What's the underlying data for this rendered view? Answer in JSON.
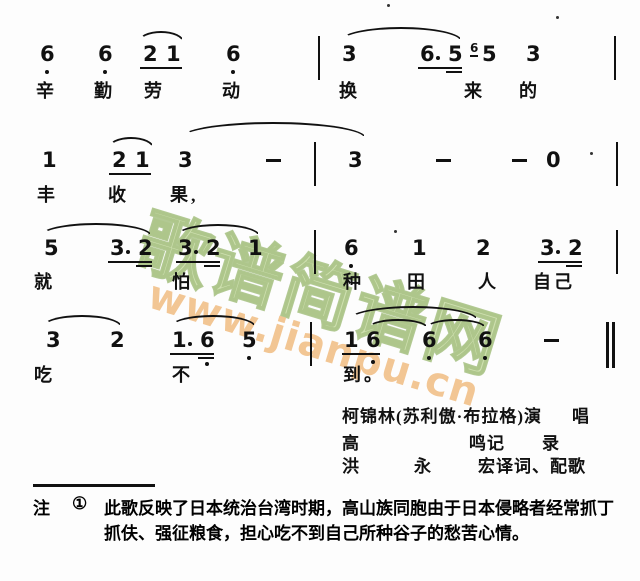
{
  "page": {
    "background": "#fdfdfd",
    "ink_color": "#111111"
  },
  "watermark": {
    "brand_text": "歌谱简谱网",
    "url_text": "www.jianpu.cn",
    "brand_color": "#cfe0b0",
    "url_color": "#f2c694"
  },
  "score": {
    "lines": [
      {
        "y": 44,
        "ly": 77,
        "items": [
          {
            "k": "slur",
            "x": 138,
            "dy": -13,
            "w": 46,
            "h": 11
          },
          {
            "k": "slur",
            "x": 340,
            "dy": -17,
            "w": 122,
            "h": 14
          },
          {
            "k": "d",
            "t": "6",
            "x": 40
          },
          {
            "k": "od",
            "x": 45
          },
          {
            "k": "d",
            "t": "6",
            "x": 98
          },
          {
            "k": "od",
            "x": 103
          },
          {
            "k": "d",
            "t": "2",
            "x": 143
          },
          {
            "k": "d",
            "t": "1",
            "x": 166
          },
          {
            "k": "u",
            "x": 140,
            "w": 42
          },
          {
            "k": "d",
            "t": "6",
            "x": 226
          },
          {
            "k": "od",
            "x": 231
          },
          {
            "k": "bar",
            "x": 318
          },
          {
            "k": "d",
            "t": "3",
            "x": 342
          },
          {
            "k": "d",
            "t": "6",
            "x": 420
          },
          {
            "k": "rdot",
            "x": 436
          },
          {
            "k": "d",
            "t": "5",
            "x": 448
          },
          {
            "k": "u",
            "x": 418,
            "w": 44
          },
          {
            "k": "u2",
            "x": 446,
            "w": 16
          },
          {
            "k": "grace",
            "t": "6",
            "x": 470
          },
          {
            "k": "d",
            "t": "5",
            "x": 482
          },
          {
            "k": "d",
            "t": "3",
            "x": 526
          },
          {
            "k": "bar",
            "x": 614
          },
          {
            "k": "spk",
            "x": 556,
            "dy": -28
          },
          {
            "k": "spk",
            "x": 387,
            "dy": -40
          }
        ],
        "lyrics": [
          {
            "x": 36,
            "t": "辛"
          },
          {
            "x": 94,
            "t": "勤"
          },
          {
            "x": 144,
            "t": "劳"
          },
          {
            "x": 222,
            "t": "动"
          },
          {
            "x": 339,
            "t": "换"
          },
          {
            "x": 464,
            "t": "来"
          },
          {
            "x": 519,
            "t": "的"
          }
        ]
      },
      {
        "y": 150,
        "ly": 181,
        "items": [
          {
            "k": "slur",
            "x": 108,
            "dy": -13,
            "w": 46,
            "h": 11
          },
          {
            "k": "slur",
            "x": 180,
            "dy": -28,
            "w": 186,
            "h": 16
          },
          {
            "k": "d",
            "t": "1",
            "x": 42
          },
          {
            "k": "d",
            "t": "2",
            "x": 112
          },
          {
            "k": "d",
            "t": "1",
            "x": 135
          },
          {
            "k": "u",
            "x": 109,
            "w": 42
          },
          {
            "k": "d",
            "t": "3",
            "x": 178
          },
          {
            "k": "dash",
            "x": 266
          },
          {
            "k": "bar",
            "x": 314
          },
          {
            "k": "d",
            "t": "3",
            "x": 348
          },
          {
            "k": "dash",
            "x": 436
          },
          {
            "k": "dash",
            "x": 512
          },
          {
            "k": "d",
            "t": "0",
            "x": 546
          },
          {
            "k": "spk",
            "x": 590,
            "dy": 2
          },
          {
            "k": "bar",
            "x": 616
          }
        ],
        "lyrics": [
          {
            "x": 37,
            "t": "丰"
          },
          {
            "x": 108,
            "t": "收"
          },
          {
            "x": 170,
            "t": "果,"
          }
        ]
      },
      {
        "y": 238,
        "ly": 268,
        "items": [
          {
            "k": "slur",
            "x": 40,
            "dy": -15,
            "w": 112,
            "h": 13
          },
          {
            "k": "slur",
            "x": 176,
            "dy": -14,
            "w": 84,
            "h": 12
          },
          {
            "k": "d",
            "t": "5",
            "x": 44
          },
          {
            "k": "d",
            "t": "3",
            "x": 110
          },
          {
            "k": "rdot",
            "x": 126
          },
          {
            "k": "d",
            "t": "2",
            "x": 138
          },
          {
            "k": "u",
            "x": 108,
            "w": 44
          },
          {
            "k": "u2",
            "x": 136,
            "w": 16
          },
          {
            "k": "d",
            "t": "3",
            "x": 178
          },
          {
            "k": "rdot",
            "x": 194
          },
          {
            "k": "d",
            "t": "2",
            "x": 206
          },
          {
            "k": "u",
            "x": 176,
            "w": 44
          },
          {
            "k": "u2",
            "x": 204,
            "w": 16
          },
          {
            "k": "d",
            "t": "1",
            "x": 248
          },
          {
            "k": "bar",
            "x": 314
          },
          {
            "k": "d",
            "t": "6",
            "x": 344
          },
          {
            "k": "od",
            "x": 349
          },
          {
            "k": "d",
            "t": "1",
            "x": 412
          },
          {
            "k": "d",
            "t": "2",
            "x": 476
          },
          {
            "k": "d",
            "t": "3",
            "x": 540
          },
          {
            "k": "rdot",
            "x": 556
          },
          {
            "k": "d",
            "t": "2",
            "x": 568
          },
          {
            "k": "u",
            "x": 538,
            "w": 44
          },
          {
            "k": "u2",
            "x": 566,
            "w": 16
          },
          {
            "k": "bar",
            "x": 616
          },
          {
            "k": "spk",
            "x": 394,
            "dy": -8
          }
        ],
        "lyrics": [
          {
            "x": 34,
            "t": "就"
          },
          {
            "x": 172,
            "t": "怕"
          },
          {
            "x": 343,
            "t": "种"
          },
          {
            "x": 407,
            "t": "田"
          },
          {
            "x": 478,
            "t": "人"
          },
          {
            "x": 533,
            "t": "自己"
          }
        ]
      },
      {
        "y": 330,
        "ly": 361,
        "items": [
          {
            "k": "slur",
            "x": 42,
            "dy": -15,
            "w": 80,
            "h": 12
          },
          {
            "k": "slur",
            "x": 170,
            "dy": -15,
            "w": 86,
            "h": 12
          },
          {
            "k": "slur",
            "x": 348,
            "dy": -24,
            "w": 130,
            "h": 14
          },
          {
            "k": "slur",
            "x": 368,
            "dy": -11,
            "w": 60,
            "h": 9
          },
          {
            "k": "slur",
            "x": 426,
            "dy": -11,
            "w": 60,
            "h": 9
          },
          {
            "k": "d",
            "t": "3",
            "x": 46
          },
          {
            "k": "d",
            "t": "2",
            "x": 110
          },
          {
            "k": "d",
            "t": "1",
            "x": 172
          },
          {
            "k": "rdot",
            "x": 188
          },
          {
            "k": "d",
            "t": "6",
            "x": 200
          },
          {
            "k": "od",
            "x": 205,
            "dy": 32
          },
          {
            "k": "u",
            "x": 170,
            "w": 44
          },
          {
            "k": "u2",
            "x": 198,
            "w": 16
          },
          {
            "k": "d",
            "t": "5",
            "x": 242
          },
          {
            "k": "od",
            "x": 247
          },
          {
            "k": "bar",
            "x": 310
          },
          {
            "k": "d",
            "t": "1",
            "x": 344
          },
          {
            "k": "d",
            "t": "6",
            "x": 366
          },
          {
            "k": "od",
            "x": 371,
            "dy": 30
          },
          {
            "k": "u",
            "x": 342,
            "w": 38
          },
          {
            "k": "d",
            "t": "6",
            "x": 422
          },
          {
            "k": "od",
            "x": 427
          },
          {
            "k": "d",
            "t": "6",
            "x": 478
          },
          {
            "k": "od",
            "x": 483
          },
          {
            "k": "dash",
            "x": 544
          },
          {
            "k": "dbar",
            "x": 606
          }
        ],
        "lyrics": [
          {
            "x": 34,
            "t": "吃"
          },
          {
            "x": 172,
            "t": "不"
          },
          {
            "x": 343,
            "t": "到。"
          }
        ]
      }
    ]
  },
  "credits": {
    "rows": [
      {
        "y": 402,
        "segments": [
          {
            "x": 342,
            "text": "柯锦林(苏利傲·布拉格)演"
          },
          {
            "x": 572,
            "text": "唱"
          }
        ]
      },
      {
        "y": 429,
        "segments": [
          {
            "x": 342,
            "text": "高"
          },
          {
            "x": 469,
            "text": "鸣记"
          },
          {
            "x": 542,
            "text": "录"
          }
        ]
      },
      {
        "y": 452,
        "segments": [
          {
            "x": 342,
            "text": "洪"
          },
          {
            "x": 414,
            "text": "永"
          },
          {
            "x": 478,
            "text": "宏译词、配歌"
          }
        ]
      }
    ]
  },
  "footnote": {
    "label": "注",
    "marker": "①",
    "line1": "此歌反映了日本统治台湾时期，高山族同胞由于日本侵略者经常抓丁",
    "line2": "抓伕、强征粮食，担心吃不到自己所种谷子的愁苦心情。"
  }
}
